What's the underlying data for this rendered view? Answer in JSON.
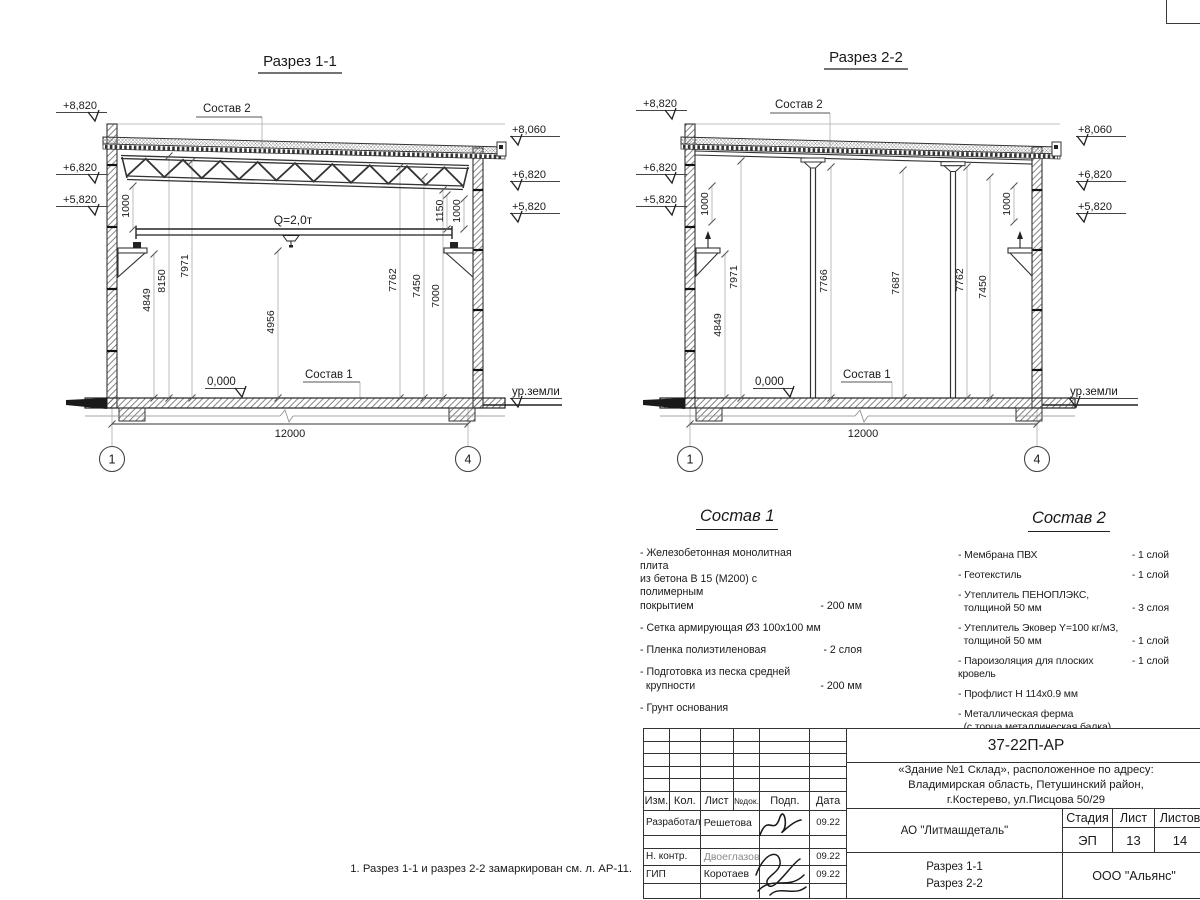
{
  "s1": {
    "title": "Разрез 1-1",
    "sostav2_label": "Состав 2",
    "sostav1_label": "Состав 1",
    "crane": "Q=2,0т",
    "zero": "0,000",
    "ground": "ур.земли",
    "span": "12000",
    "axis_l": "1",
    "axis_r": "4",
    "elev_l": [
      "+8,820",
      "+6,820",
      "+5,820"
    ],
    "elev_r": [
      "+8,060",
      "+6,820",
      "+5,820"
    ],
    "off_l": "1000",
    "off_r1": "1150",
    "off_r2": "1000",
    "dims": [
      "4849",
      "8150",
      "7971",
      "4956",
      "7762",
      "7450",
      "7000"
    ]
  },
  "s2": {
    "title": "Разрез 2-2",
    "sostav2_label": "Состав 2",
    "sostav1_label": "Состав 1",
    "zero": "0,000",
    "ground": "ур.земли",
    "span": "12000",
    "axis_l": "1",
    "axis_r": "4",
    "elev_l": [
      "+8,820",
      "+6,820",
      "+5,820"
    ],
    "elev_r": [
      "+8,060",
      "+6,820",
      "+5,820"
    ],
    "off_l": "1000",
    "off_r": "1000",
    "dims": [
      "4849",
      "7971",
      "7766",
      "7687",
      "7762",
      "7450"
    ]
  },
  "sostav1": {
    "title": "Состав 1",
    "items": [
      {
        "name": "- Железобетонная  монолитная плита\nиз бетона В 15 (М200) с полимерным\nпокрытием",
        "value": "- 200 мм"
      },
      {
        "name": "- Сетка армирующая Ø3 100x100 мм"
      },
      {
        "name": "- Пленка полиэтиленовая",
        "value": "-  2 слоя"
      },
      {
        "name": "- Подготовка из песка средней\n  крупности",
        "value": "- 200 мм"
      },
      {
        "name": "- Грунт основания"
      }
    ]
  },
  "sostav2": {
    "title": "Состав 2",
    "items": [
      {
        "name": "- Мембрана ПВХ",
        "value": "- 1 слой"
      },
      {
        "name": "- Геотекстиль",
        "value": "- 1 слой"
      },
      {
        "name": "- Утеплитель ПЕНОПЛЭКС,\n  толщиной 50 мм",
        "value": "- 3 слоя"
      },
      {
        "name": "- Утеплитель Эковер Y=100 кг/м3,\n  толщиной 50 мм",
        "value": "- 1 слой"
      },
      {
        "name": "- Пароизоляция для плоских кровель",
        "value": "- 1 слой"
      },
      {
        "name": "- Профлист Н 114x0.9 мм"
      },
      {
        "name": "- Металлическая ферма\n  (с торца металлическая балка)"
      }
    ]
  },
  "titleblock": {
    "doc": "37-22П-АР",
    "object": "«Здание №1 Склад», расположенное по адресу:\nВладимирская область, Петушинский район,\nг.Костерево, ул.Писцова 50/29",
    "cols": {
      "izm": "Изм.",
      "kol": "Кол.",
      "list": "Лист",
      "ndoc": "№док.",
      "podp": "Подп.",
      "date": "Дата"
    },
    "rows": [
      {
        "role": "Разработал",
        "name": "Решетова",
        "date": "09.22"
      },
      {
        "role": "Н. контр.",
        "name": "Двоеглазов",
        "date": "09.22"
      },
      {
        "role": "ГИП",
        "name": "Коротаев",
        "date": "09.22"
      }
    ],
    "company": "АО \"Литмашдеталь\"",
    "stage_h": "Стадия",
    "list_h": "Лист",
    "lists_h": "Листов",
    "stage": "ЭП",
    "list": "13",
    "lists": "14",
    "content": "Разрез 1-1\nРазрез 2-2",
    "org": "ООО \"Альянс\""
  },
  "note": "1. Разрез 1-1 и разрез 2-2 замаркирован см. л. АР-11."
}
